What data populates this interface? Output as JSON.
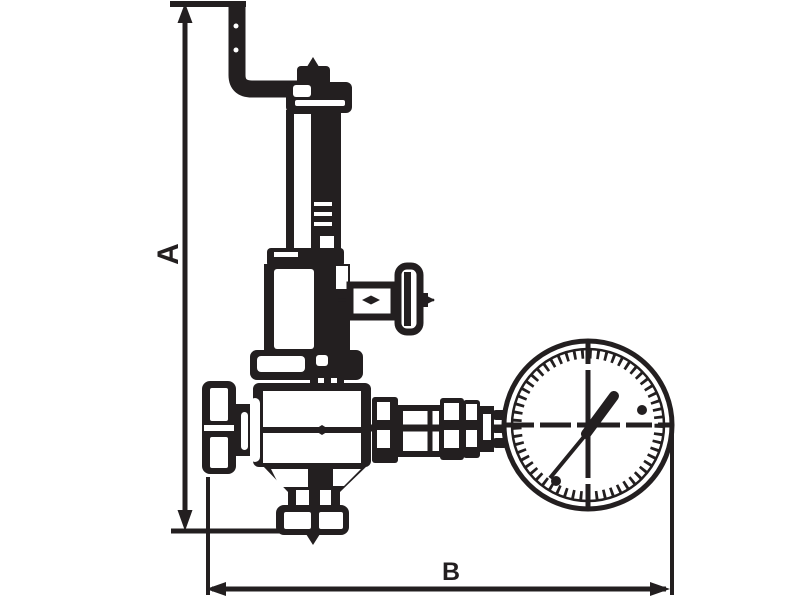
{
  "page": {
    "background_color": "#ffffff"
  },
  "drawing": {
    "type": "technical-line-drawing",
    "subject": "Pressure reducing valve with crank handle, side tee valve and pressure gauge",
    "line_color": "#231f20",
    "fill_color": "#ffffff"
  },
  "dimensions": {
    "a": {
      "label": "A",
      "orientation": "vertical"
    },
    "b": {
      "label": "B",
      "orientation": "horizontal"
    }
  },
  "components": [
    "crank-handle",
    "spindle-cap",
    "bonnet-tube",
    "spring-housing",
    "side-tee-valve",
    "union-nut",
    "valve-body",
    "inlet-knob",
    "outlet-coupling",
    "pressure-gauge",
    "gauge-needle",
    "bottom-flange"
  ]
}
